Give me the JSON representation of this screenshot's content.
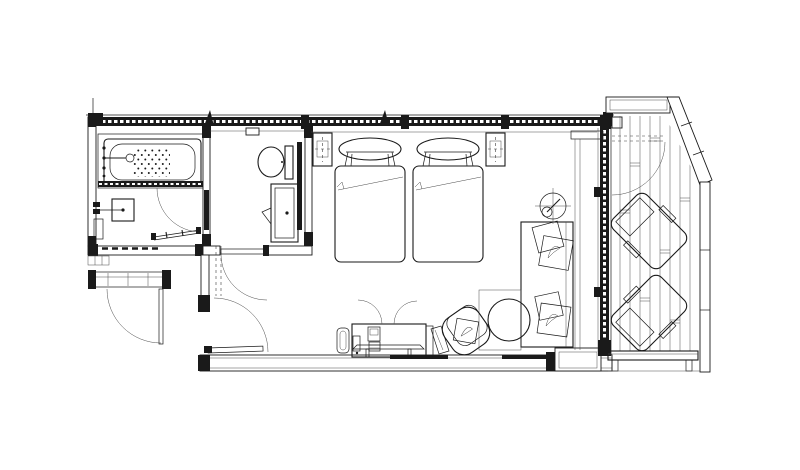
{
  "document": {
    "type": "architectural-floor-plan",
    "title": "Hotel twin guest room floor plan with bathroom, toilet room, entry vestibule and wooden balcony",
    "visible_text": "none",
    "colors": {
      "paper": "#ffffff",
      "ink": "#1a1a1a",
      "wall_fill": "#1a1a1a",
      "detail_line": "#4a4a4a"
    }
  },
  "rooms": [
    {
      "name": "bathroom",
      "items": [
        "bathtub",
        "bath-faucet",
        "shower-head",
        "water-heater",
        "glass-shower-door"
      ]
    },
    {
      "name": "toilet-room",
      "items": [
        "toilet",
        "vanity-sink",
        "mirror",
        "toilet-door"
      ]
    },
    {
      "name": "entry-vestibule",
      "items": [
        "entry-door",
        "closet-shelf",
        "closet-door"
      ]
    },
    {
      "name": "bedroom",
      "items": [
        "twin-bed-1",
        "twin-bed-2",
        "pillow-1",
        "pillow-2",
        "nightstand-left",
        "nightstand-right",
        "sofa-daybed",
        "sofa-cushions",
        "floor-lamp",
        "round-side-table",
        "armchair",
        "luggage-rack",
        "desk-cabinet",
        "stool",
        "curtain-box"
      ]
    },
    {
      "name": "balcony",
      "items": [
        "deck-boards",
        "lounge-chair-1",
        "lounge-chair-2",
        "bench",
        "balcony-rail",
        "balcony-door"
      ]
    }
  ]
}
